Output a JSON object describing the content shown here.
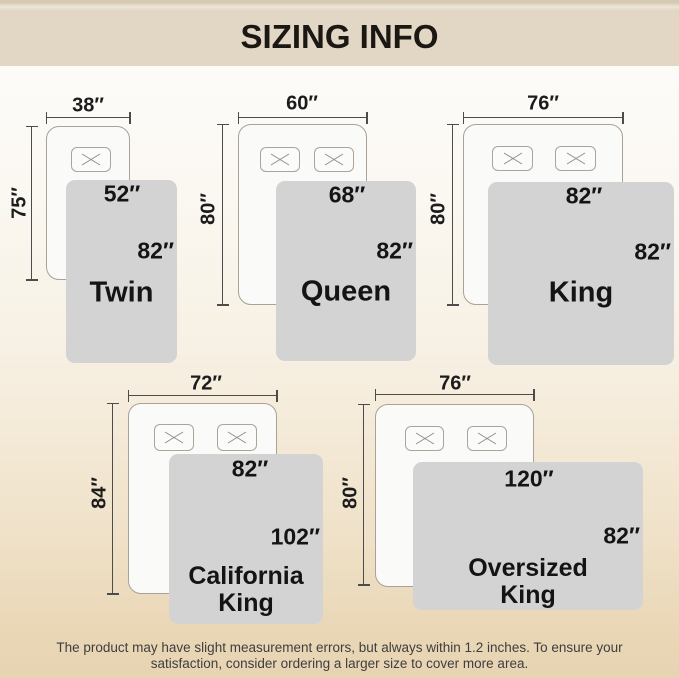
{
  "header": {
    "title": "SIZING INFO"
  },
  "diagrams": [
    {
      "name": "Twin",
      "mattress_width": "38″",
      "mattress_length": "75″",
      "blanket_width": "52″",
      "blanket_length": "82″"
    },
    {
      "name": "Queen",
      "mattress_width": "60″",
      "mattress_length": "80″",
      "blanket_width": "68″",
      "blanket_length": "82″"
    },
    {
      "name": "King",
      "mattress_width": "76″",
      "mattress_length": "80″",
      "blanket_width": "82″",
      "blanket_length": "82″"
    },
    {
      "name": "California King",
      "mattress_width": "72″",
      "mattress_length": "84″",
      "blanket_width": "82″",
      "blanket_length": "102″"
    },
    {
      "name": "Oversized King",
      "mattress_width": "76″",
      "mattress_length": "80″",
      "blanket_width": "120″",
      "blanket_length": "82″"
    }
  ],
  "footer": {
    "line1": "The product may have slight measurement errors, but always within 1.2 inches. To ensure your",
    "line2": "satisfaction, consider ordering a larger size to cover more area."
  },
  "icons": {
    "pillow_marker": "x-cross"
  },
  "colors": {
    "header_bg": "#e2d7c5",
    "background_top": "#fdfdfc",
    "background_bottom": "#e7d4b3",
    "blanket": "#d3d3d3",
    "mattress": "#fafaf8",
    "outline": "#a8a298",
    "dimension_line": "#4c4c4c",
    "text": "#1a1a1a"
  }
}
